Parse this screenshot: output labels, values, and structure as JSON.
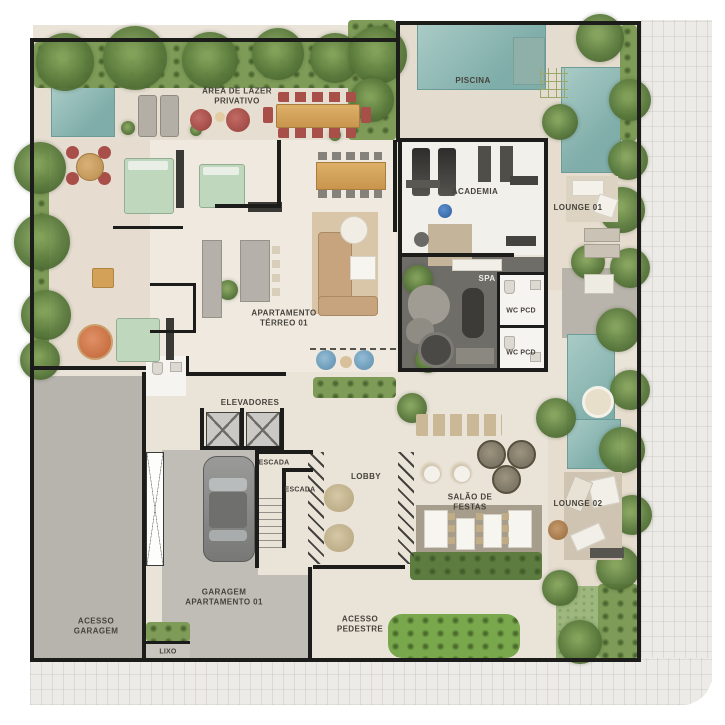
{
  "plan": {
    "type": "residential ground floor plan",
    "rooms": {
      "area_lazer": {
        "label": "ÁREA DE LAZER\nPRIVATIVO"
      },
      "piscina": {
        "label": "PISCINA"
      },
      "academia": {
        "label": "ACADEMIA"
      },
      "lounge_01": {
        "label": "LOUNGE 01"
      },
      "spa": {
        "label": "SPA"
      },
      "wc_pcd_1": {
        "label": "WC PCD"
      },
      "wc_pcd_2": {
        "label": "WC PCD"
      },
      "apartamento": {
        "label": "APARTAMENTO\nTÉRREO 01"
      },
      "elevadores": {
        "label": "ELEVADORES"
      },
      "escada_1": {
        "label": "ESCADA"
      },
      "escada_2": {
        "label": "ESCADA"
      },
      "lobby": {
        "label": "LOBBY"
      },
      "salao_festas": {
        "label": "SALÃO DE\nFESTAS"
      },
      "lounge_02": {
        "label": "LOUNGE 02"
      },
      "garagem_apto": {
        "label": "GARAGEM\nAPARTAMENTO  01"
      },
      "acesso_garagem": {
        "label": "ACESSO\nGARAGEM"
      },
      "acesso_pedestre": {
        "label": "ACESSO\nPEDESTRE"
      },
      "lixo": {
        "label": "LIXO"
      }
    },
    "colors": {
      "wall": "#1c1c1a",
      "floor_beige": "#eae3d8",
      "deck_beige": "#e3dbcd",
      "pool_teal": "#7fada9",
      "hedge_green": "#7e9c58",
      "spa_floor": "#6f6d68",
      "ramp_gray": "#b7b4ae",
      "accent_red": "#a84f4a",
      "wood": "#d3a258",
      "pouf_orange": "#d07a4e",
      "pouf_blue": "#7aa7c7"
    }
  }
}
